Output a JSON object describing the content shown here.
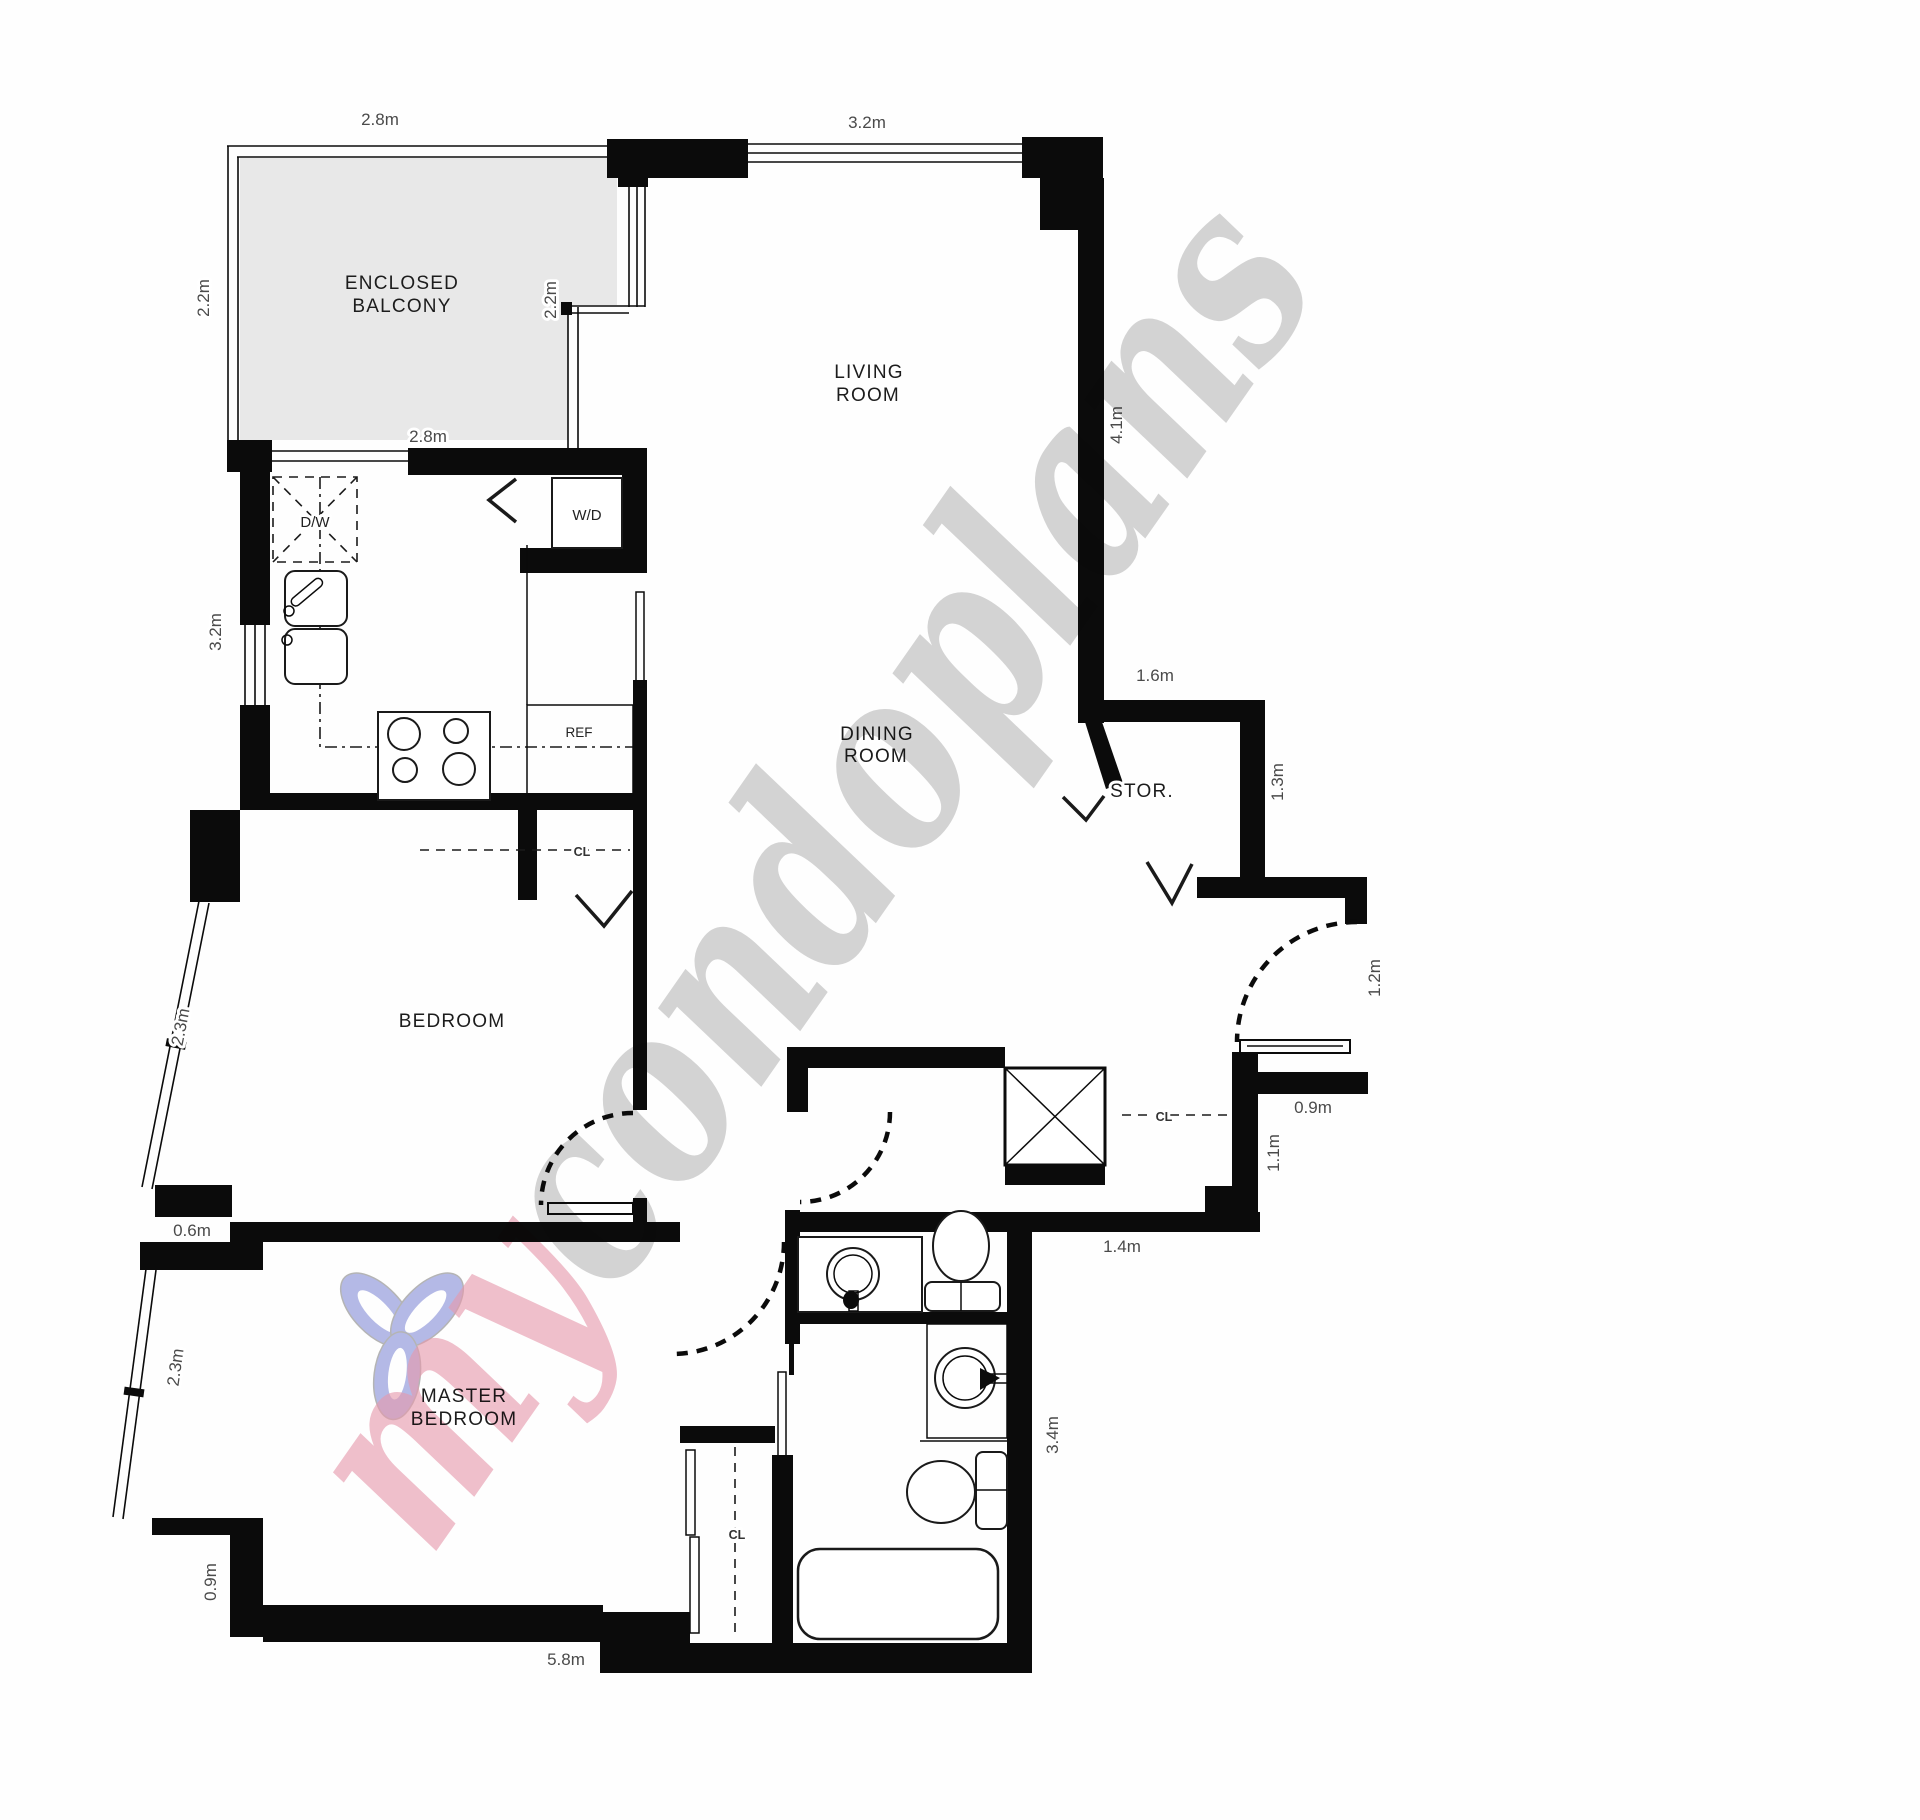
{
  "rooms": {
    "balcony": [
      "ENCLOSED",
      "BALCONY"
    ],
    "living": [
      "LIVING",
      "ROOM"
    ],
    "dining": [
      "DINING",
      "ROOM"
    ],
    "bedroom": "BEDROOM",
    "master": [
      "MASTER",
      "BEDROOM"
    ],
    "storage": "STOR."
  },
  "fixtures": {
    "dishwasher": "D/W",
    "washer_dryer": "W/D",
    "fridge": "REF",
    "closet": "CL"
  },
  "dimensions": {
    "balcony_top": "2.8m",
    "balcony_bottom": "2.8m",
    "balcony_left": "2.2m",
    "balcony_right": "2.2m",
    "living_top": "3.2m",
    "living_right": "4.1m",
    "kitchen_left": "3.2m",
    "storage_top": "1.6m",
    "storage_right": "1.3m",
    "entry_right": "1.2m",
    "entry_closet": "0.9m",
    "hall_right": "1.1m",
    "hall_bottom": "1.4m",
    "bath_right": "3.4m",
    "bedroom_window": "2.3m",
    "bedroom_step": "0.6m",
    "master_window": "2.3m",
    "master_left": "0.9m",
    "master_bottom": "5.8m"
  },
  "watermark": {
    "word1": "my",
    "word2": "condoplans"
  },
  "colors": {
    "balcony_fill": "#e8e8e8",
    "watermark_pink": "#e08098",
    "watermark_gray": "#a9a9a9",
    "watermark_blue": "#99a0de",
    "wall": "#0b0b0b"
  }
}
